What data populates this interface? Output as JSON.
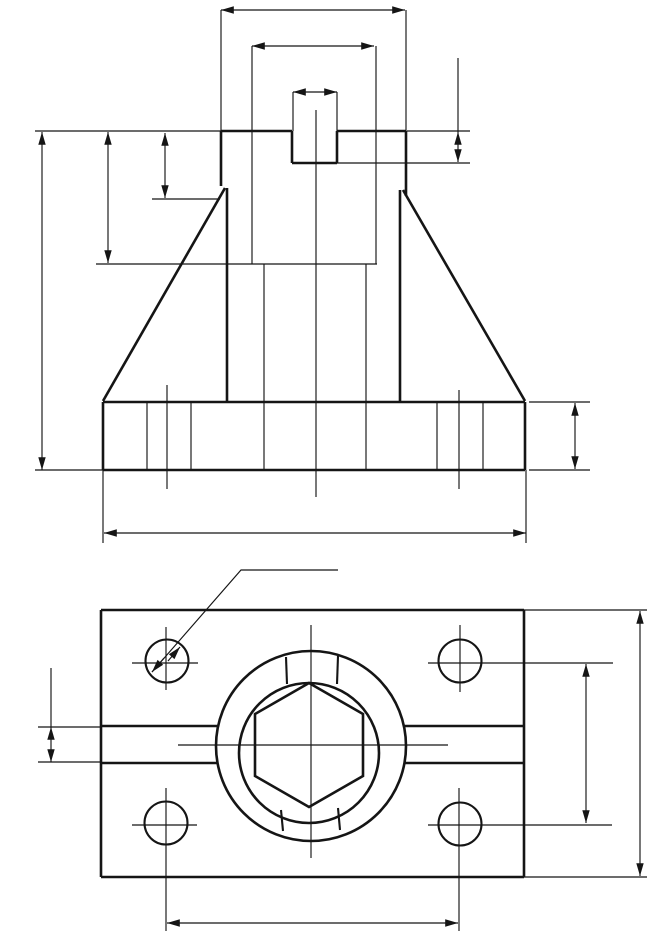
{
  "meta": {
    "drawing_type": "orthographic technical drawing, unlabeled dimension lines",
    "colors": {
      "ink": "#151515",
      "background": "#ffffff"
    },
    "canvas": {
      "width": 649,
      "height": 931
    }
  },
  "views": [
    {
      "id": "front-view",
      "label": "front elevation of bracket (base plate, side gussets, central boss with top slot)",
      "thick_lines": [
        [
          221,
          131,
          221,
          186
        ],
        [
          221,
          131,
          292,
          131
        ],
        [
          337,
          131,
          406,
          131
        ],
        [
          292,
          131,
          292,
          163
        ],
        [
          337,
          131,
          337,
          163
        ],
        [
          292,
          163,
          337,
          163
        ],
        [
          406,
          131,
          406,
          196
        ],
        [
          225,
          188,
          103,
          401
        ],
        [
          403,
          190,
          525,
          401
        ],
        [
          227,
          188,
          227,
          402
        ],
        [
          400,
          190,
          400,
          402
        ],
        [
          103,
          402,
          525,
          402
        ],
        [
          103,
          470,
          525,
          470
        ],
        [
          103,
          402,
          103,
          470
        ],
        [
          525,
          402,
          525,
          470
        ]
      ],
      "medium_lines": [],
      "proj_lines": [
        [
          147,
          402,
          147,
          470
        ],
        [
          191,
          402,
          191,
          470
        ],
        [
          437,
          402,
          437,
          470
        ],
        [
          483,
          402,
          483,
          470
        ],
        [
          264,
          264,
          264,
          470
        ],
        [
          366,
          264,
          366,
          470
        ]
      ],
      "center_lines": [
        [
          316,
          110,
          316,
          497
        ],
        [
          167,
          385,
          167,
          489
        ],
        [
          459,
          390,
          459,
          489
        ]
      ],
      "ext_lines": [
        [
          35,
          131,
          221,
          131
        ],
        [
          407,
          131,
          470,
          131
        ],
        [
          337,
          163,
          470,
          163
        ],
        [
          96,
          264,
          377,
          264
        ],
        [
          152,
          199,
          220,
          199
        ],
        [
          35,
          470,
          103,
          470
        ],
        [
          529,
          402,
          590,
          402
        ],
        [
          529,
          470,
          590,
          470
        ],
        [
          103,
          470,
          103,
          543
        ],
        [
          526,
          470,
          526,
          543
        ],
        [
          221,
          10,
          221,
          131
        ],
        [
          406,
          10,
          406,
          131
        ],
        [
          252,
          46,
          252,
          264
        ],
        [
          376,
          46,
          376,
          264
        ],
        [
          293,
          92,
          293,
          131
        ],
        [
          337,
          92,
          337,
          131
        ],
        [
          458,
          58,
          458,
          132
        ]
      ],
      "dim_lines": [
        [
          221,
          10,
          405,
          10
        ],
        [
          252,
          46,
          374,
          46
        ],
        [
          293,
          92,
          337,
          92
        ],
        [
          458,
          132,
          458,
          162
        ],
        [
          42,
          132,
          42,
          470
        ],
        [
          108,
          132,
          108,
          263
        ],
        [
          165,
          133,
          165,
          198
        ],
        [
          104,
          533,
          526,
          533
        ],
        [
          575,
          403,
          575,
          469
        ]
      ],
      "leader_arrows": [],
      "polylines": [],
      "circles": [],
      "polygons": []
    },
    {
      "id": "top-view",
      "label": "plan view of base plate with four corner holes, central boss, hex socket and through slot",
      "thick_lines": [
        [
          101,
          610,
          524,
          610
        ],
        [
          101,
          877,
          524,
          877
        ],
        [
          101,
          610,
          101,
          877
        ],
        [
          524,
          610,
          524,
          877
        ],
        [
          101,
          726,
          218,
          726
        ],
        [
          404,
          726,
          524,
          726
        ],
        [
          101,
          763,
          217,
          763
        ],
        [
          405,
          763,
          524,
          763
        ]
      ],
      "medium_lines": [
        [
          286,
          657,
          287,
          684
        ],
        [
          338,
          656,
          337,
          684
        ],
        [
          281,
          810,
          283,
          831
        ],
        [
          338,
          808,
          340,
          830
        ]
      ],
      "proj_lines": [],
      "center_lines": [
        [
          132,
          663,
          198,
          663
        ],
        [
          166,
          627,
          166,
          690
        ],
        [
          428,
          663,
          613,
          663
        ],
        [
          460,
          625,
          460,
          692
        ],
        [
          132,
          825,
          197,
          825
        ],
        [
          166,
          788,
          166,
          931
        ],
        [
          428,
          825,
          612,
          825
        ],
        [
          459,
          788,
          459,
          931
        ],
        [
          178,
          745,
          448,
          745
        ],
        [
          311,
          625,
          311,
          858
        ]
      ],
      "ext_lines": [
        [
          38,
          727,
          101,
          727
        ],
        [
          38,
          762,
          101,
          762
        ],
        [
          524,
          610,
          647,
          610
        ],
        [
          524,
          877,
          647,
          877
        ],
        [
          51,
          668,
          51,
          727
        ]
      ],
      "dim_lines": [
        [
          51,
          727,
          51,
          762
        ],
        [
          640,
          611,
          640,
          876
        ],
        [
          586,
          664,
          586,
          823
        ],
        [
          167,
          923,
          458,
          923
        ]
      ],
      "leader_arrows": [
        [
          164,
          658,
          152,
          672
        ],
        [
          168,
          661,
          180,
          647
        ]
      ],
      "polylines": [
        [
          [
            152,
            672
          ],
          [
            241,
            570
          ],
          [
            338,
            570
          ]
        ]
      ],
      "circles": [
        {
          "name": "boss-outer-circle",
          "cx": 311,
          "cy": 746,
          "r": 95,
          "weight": "thick"
        },
        {
          "name": "boss-inner-circle",
          "cx": 309,
          "cy": 753,
          "r": 70,
          "weight": "thick"
        },
        {
          "name": "corner-hole",
          "cx": 167,
          "cy": 661,
          "r": 21.5,
          "weight": "medium"
        },
        {
          "name": "corner-hole",
          "cx": 460,
          "cy": 661,
          "r": 21.5,
          "weight": "medium"
        },
        {
          "name": "corner-hole",
          "cx": 166,
          "cy": 823,
          "r": 21.5,
          "weight": "medium"
        },
        {
          "name": "corner-hole",
          "cx": 460,
          "cy": 824,
          "r": 21.5,
          "weight": "medium"
        }
      ],
      "polygons": [
        {
          "name": "hex-socket-outline",
          "points": [
            [
              309,
              683
            ],
            [
              363,
              714
            ],
            [
              363,
              776
            ],
            [
              309,
              807
            ],
            [
              255,
              776
            ],
            [
              255,
              714
            ]
          ],
          "weight": "thick"
        }
      ]
    }
  ]
}
